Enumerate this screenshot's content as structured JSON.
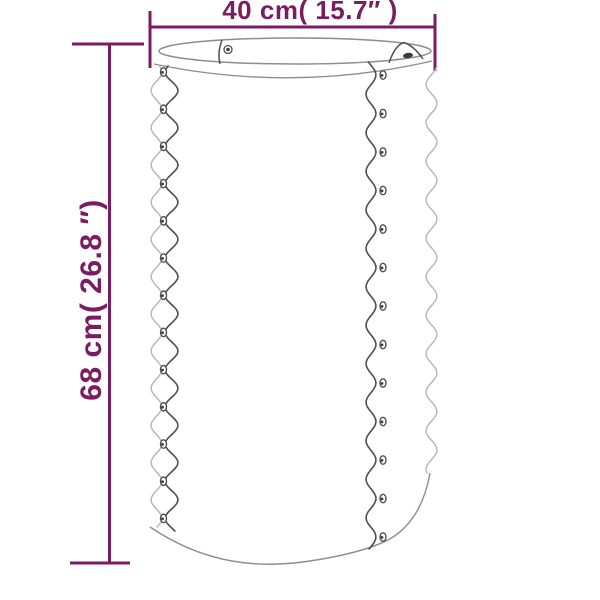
{
  "diagram": {
    "type": "product-dimension-diagram",
    "product_icon": "corrugated-round-planter-illustration",
    "dimensions": {
      "width": {
        "label": "40 cm( 15.7″ )",
        "value_cm": 40,
        "value_in": 15.7
      },
      "height": {
        "label": "68 cm( 26.8 ″)",
        "value_cm": 68,
        "value_in": 26.8
      }
    },
    "colors": {
      "dimension_accent": "#7b1c63",
      "outline": "#8d8d8d",
      "outline_light": "#b5b5b5",
      "seam": "#4f4f4f",
      "rivet_dark": "#3c3c3c",
      "background": "#ffffff"
    }
  }
}
